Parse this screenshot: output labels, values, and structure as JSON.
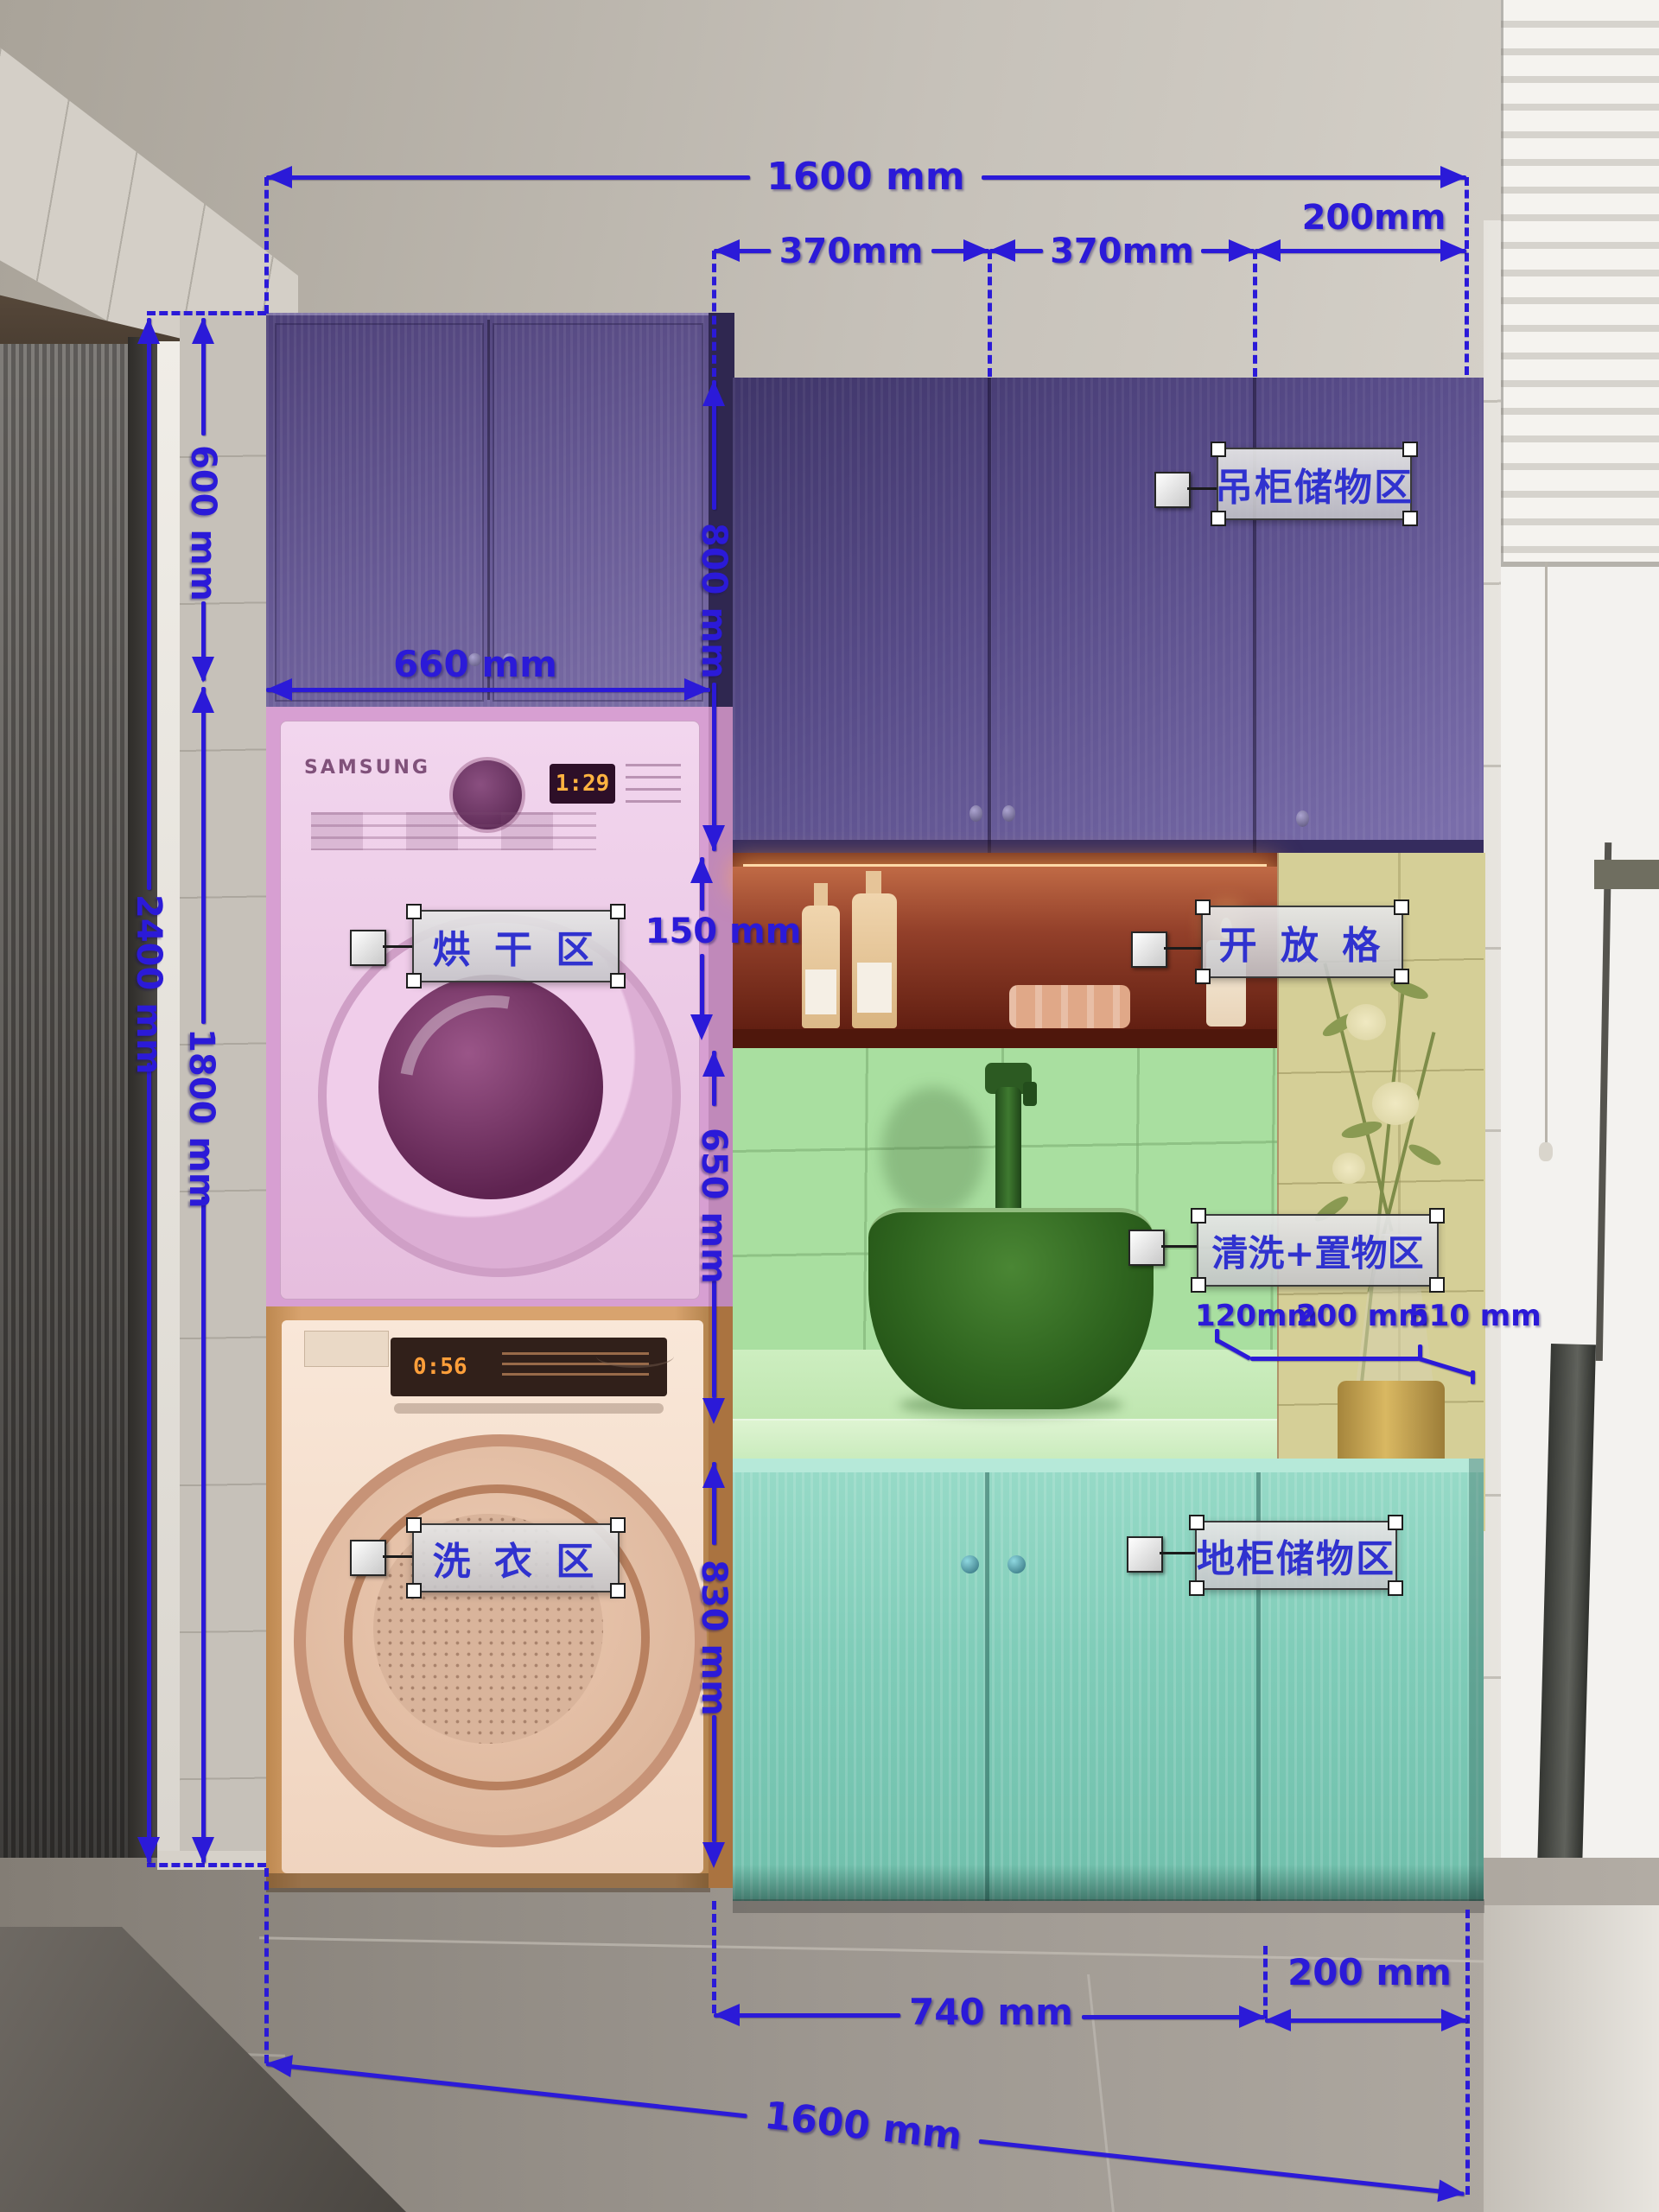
{
  "annotation_color": "#2b1ad8",
  "zones": [
    {
      "id": "hanging-cabinet",
      "label": "吊柜储物区",
      "color": "#5a4d8a"
    },
    {
      "id": "drying-area",
      "label": "烘 干 区",
      "color": "#d79fd2"
    },
    {
      "id": "open-shelf",
      "label": "开 放 格",
      "color": "#93402a"
    },
    {
      "id": "wash-storage",
      "label": "清洗+置物区",
      "color": "#a9dfa0"
    },
    {
      "id": "laundry-area",
      "label": "洗 衣 区",
      "color": "#d8a36e"
    },
    {
      "id": "base-cabinet",
      "label": "地柜储物区",
      "color": "#7fccb8"
    }
  ],
  "dimensions": {
    "top_total": "1600 mm",
    "top_segments": [
      "370mm",
      "370mm",
      "200mm"
    ],
    "left_total_height": "2400 mm",
    "hanging_cabinet_height": "600 mm",
    "lower_section_height": "1800 mm",
    "wall_cabinet_height": "800 mm",
    "dryer_column_width": "660 mm",
    "open_shelf_height": "150 mm",
    "backsplash_height": "650 mm",
    "base_cabinet_height": "830 mm",
    "counter_segments": [
      "120mm",
      "200 mm",
      "510 mm"
    ],
    "bottom_left": "740 mm",
    "bottom_right": "200 mm",
    "bottom_total": "1600 mm"
  },
  "appliances": {
    "dryer_brand": "SAMSUNG",
    "dryer_display": "1:29",
    "washer_display": "0:56"
  }
}
